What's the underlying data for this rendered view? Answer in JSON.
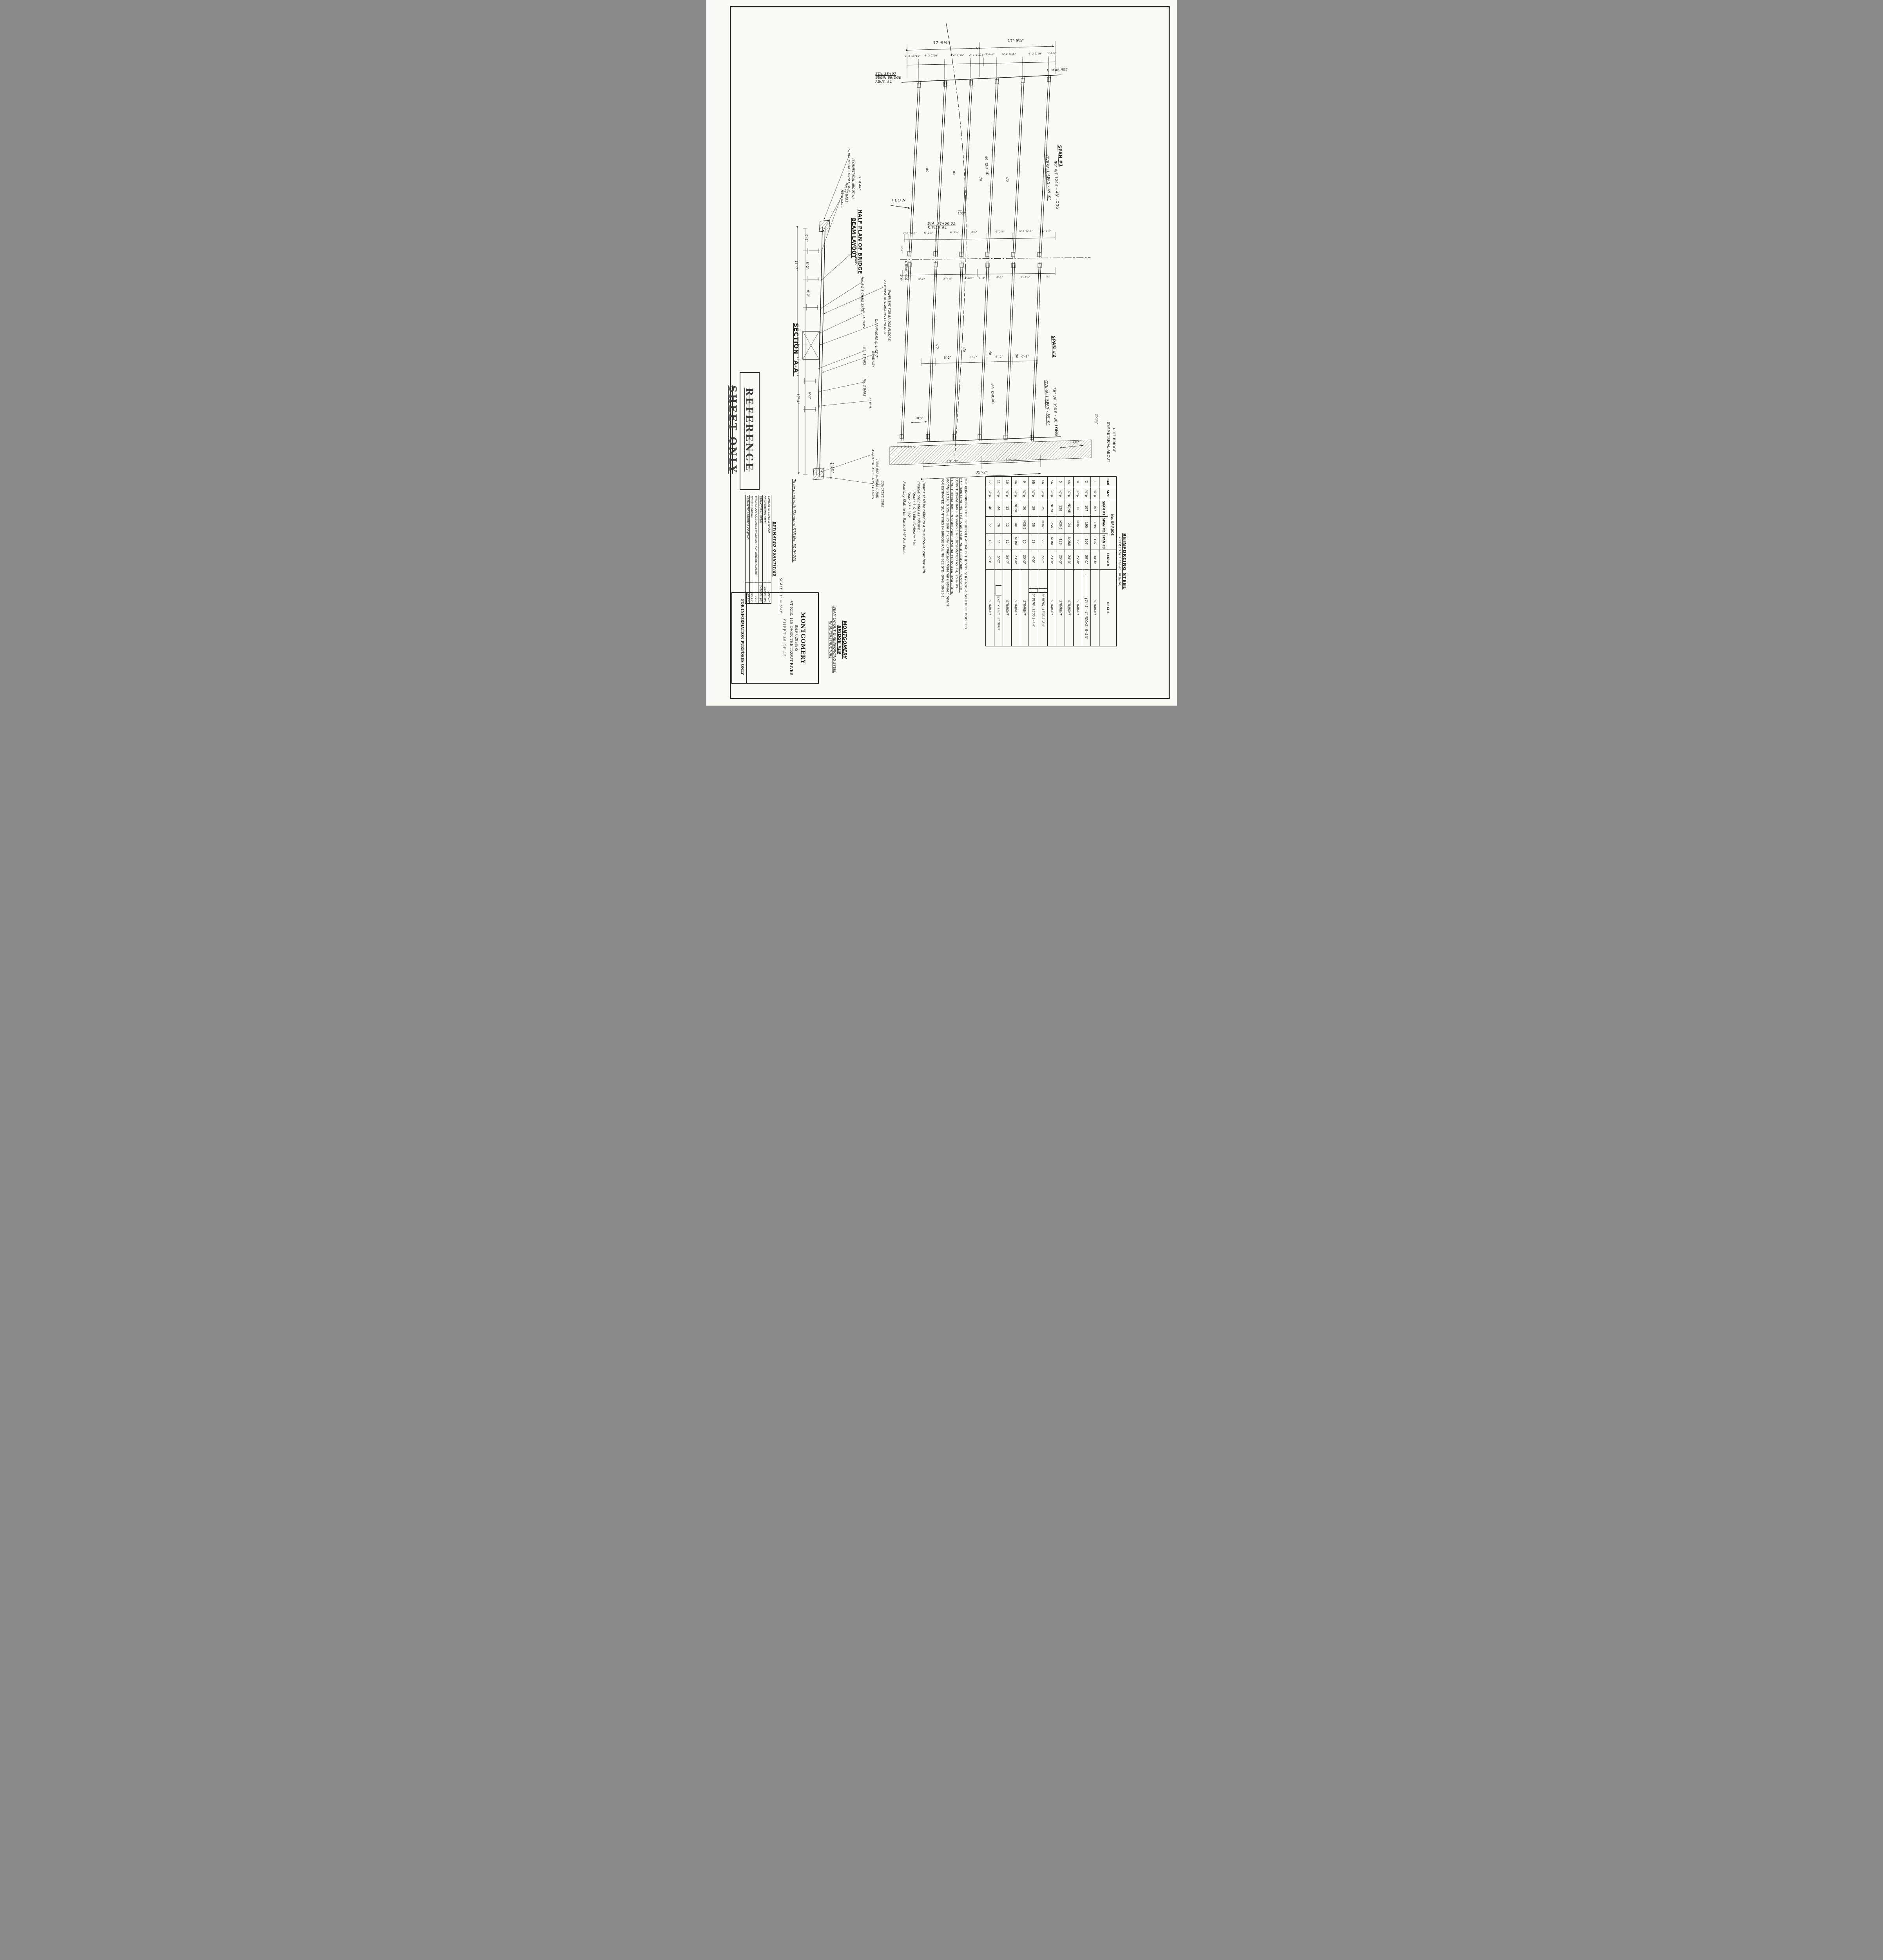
{
  "sheet": {
    "stamp": "REFERENCE SHEET ONLY",
    "scale_note": "SCALE : 1\" = 5'-0\"",
    "usage_note": "To be used with Standard S1B No. 30 (H-20).",
    "info_note": "FOR INFORMATION PURPOSES ONLY"
  },
  "title_block": {
    "town": "MONTGOMERY",
    "project": "BHF 0283(8)S",
    "route": "VT RTE. 118 OVER THE TROUT RIVER",
    "sheet_no": "SHEET 45 OF 45",
    "hand_title": [
      "MONTGOMERY",
      "BRIDGE #19",
      "BEAM LAYOUT & REINFORCING STEEL",
      "IN SUPERSTRUCTURE"
    ]
  },
  "quantities": {
    "title": "ESTIMATED QUANTITIES",
    "rows": [
      {
        "item": "CONCRETE CLASS B (MOD)",
        "qty": "198 C.Y."
      },
      {
        "item": "REINFORCING STEEL",
        "qty": "44240 LBS."
      },
      {
        "item": "STRUCTURAL STEEL",
        "qty": "247090 LBS."
      },
      {
        "item": "BITUMINOUS CONCRETE PAVEMENT FOR BRIDGE FLOORS",
        "qty": "70 T."
      },
      {
        "item": "BRIDGE RAILING",
        "qty": "379 L.F."
      },
      {
        "item": "ASPHALTIC ASBESTOS COATING",
        "qty": "67 S.Y."
      }
    ]
  },
  "rebar": {
    "title": "REINFORCING STEEL",
    "subtitle": "REFER TO STD. S1B No. 30 (H-20)",
    "h_bar": "BAR",
    "h_size": "SIZE",
    "h_rods": "No. OF RODS",
    "h_span1": "SPAN #1",
    "h_span2": "SPAN #2",
    "h_span3": "SPAN #3",
    "h_length": "LENGTH",
    "h_detail": "DETAIL",
    "straight": "STRAIGHT",
    "rows": [
      {
        "bar": "1",
        "size": "⅝\"φ",
        "s1": "107",
        "s2": "195",
        "s3": "107",
        "len": "34'-6\"",
        "detail": "STRAIGHT"
      },
      {
        "bar": "2",
        "size": "⅝\"φ",
        "s1": "107",
        "s2": "195",
        "s3": "107",
        "len": "36'-1\"",
        "detail": "34'-1\" · 4\" HOOKS · R=2½\""
      },
      {
        "bar": "4",
        "size": "¾\"φ",
        "s1": "12",
        "s2": "NONE",
        "s3": "12",
        "len": "25'-8\"",
        "detail": "STRAIGHT"
      },
      {
        "bar": "4A",
        "size": "¾\"φ",
        "s1": "NONE",
        "s2": "24",
        "s3": "NONE",
        "len": "24'-3\"",
        "detail": "STRAIGHT"
      },
      {
        "bar": "5",
        "size": "½\"φ",
        "s1": "128",
        "s2": "NONE",
        "s3": "128",
        "len": "25'-3\"",
        "detail": "STRAIGHT"
      },
      {
        "bar": "5A",
        "size": "½\"φ",
        "s1": "NONE",
        "s2": "256",
        "s3": "NONE",
        "len": "23'-8\"",
        "detail": "STRAIGHT"
      },
      {
        "bar": "6A",
        "size": "½\"φ",
        "s1": "29",
        "s2": "NONE",
        "s3": "29",
        "len": "5'-7\"",
        "detail": "8\" BEND · LEGS 2'-2½\""
      },
      {
        "bar": "6B",
        "size": "½\"φ",
        "s1": "29",
        "s2": "58",
        "s3": "29",
        "len": "4'-5\"",
        "detail": "8\" BEND · LEGS 1'-7¼\""
      },
      {
        "bar": "9",
        "size": "½\"φ",
        "s1": "20",
        "s2": "NONE",
        "s3": "20",
        "len": "25'-3\"",
        "detail": "STRAIGHT"
      },
      {
        "bar": "9A",
        "size": "½\"φ",
        "s1": "NONE",
        "s2": "40",
        "s3": "NONE",
        "len": "23'-8\"",
        "detail": "STRAIGHT"
      },
      {
        "bar": "10",
        "size": "⅜\"φ",
        "s1": "12",
        "s2": "12",
        "s3": "12",
        "len": "34'-7\"",
        "detail": "STRAIGHT"
      },
      {
        "bar": "11",
        "size": "½\"φ",
        "s1": "44",
        "s2": "76",
        "s3": "44",
        "len": "5'-2\"",
        "detail": "2'-2\" × 1'-3\" · 3\" HOOK"
      },
      {
        "bar": "12",
        "size": "½\"φ",
        "s1": "40",
        "s2": "72",
        "s3": "40",
        "len": "2'-3\"",
        "detail": "STRAIGHT"
      }
    ]
  },
  "notes": {
    "n1": "THE REINFORCING STEEL SCHEDULE ABOVE IS THE STD. S1B (H-20)-1 SCHEDULE MODIFIED",
    "n2": "BY ELIMINATING No. 3 BARS AND SPACING #1 & #2 BARS @ 5½\" C/C.",
    "n3": "LONGITUDINAL BARS IN SPANS 1 & 3 DESIGNATED AS #4, #5 & #9.",
    "n4": "LONGITUDINAL BARS IN SPAN 2 ARE DESIGNATED AS #4A, #5A & #9A.",
    "n5": "Modify S1B30 (H20)-1 to use 1\" Cork Expansion Material Between Spans.",
    "n6": "FOR ESTIMATED QUANTITIES IN BRIDGE RAILING SEE STD. DWG. 38-55-1",
    "c1": "Beams shall be rolled to a true circular camber with",
    "c2": "middle ordinates as follows :",
    "c3": "Spans 1 & 3   Mid. Ordinate  1⅛\"",
    "c4": "Span  2            \"            \"            3¾\"",
    "c5": "Roadway Slab to be Banked ½\" Per Foot."
  },
  "plan": {
    "half_plan_1": "HALF PLAN OF BRIDGE",
    "half_plan_2": "BEAM LAYOUT",
    "flow": "FLOW",
    "ditto": "do",
    "angle": "102°",
    "sta_begin_1": "STA. 38+07",
    "sta_begin_2": "BEGIN BRIDGE",
    "sta_begin_3": "ABUT. #1",
    "sta_pier_1": "STA. 38+56.01",
    "sta_pier_2": "℄ PIER #1",
    "bearings": "℄ BEARINGS",
    "sym_1": "SYMMETRICAL ABOUT",
    "sym_2": "℄ OF BRIDGE",
    "span1": {
      "title": "SPAN #1",
      "overall": "OVERALL SPAN - 49'-0\"",
      "beam": "30\" WF 124# - 48' LONG",
      "chord": "49' CHORD"
    },
    "span2": {
      "title": "SPAN #2",
      "overall": "OVERALL SPAN - 89'-0\"",
      "beam": "36\" WF 300# - 88' LONG",
      "chord": "89' CHORD"
    },
    "dims": {
      "top": [
        "17'-9⅜\"",
        "17'-9⅝\""
      ],
      "sub": [
        "2'-8 13/16\"",
        "6'-2 7/16\"",
        "6'-2 7/16\"",
        "2'-7 11/16\"",
        "3'-6⅛\"",
        "6'-2 7/16\"",
        "6'-2 7/16\"",
        "1'-9⅜\""
      ],
      "pier_above": [
        "2'-6 7/16\"",
        "6'-2⅞\"",
        "6'-2⅞\"",
        "2⅞\"",
        "6'-2⅞\"",
        "6'-2 7/16\"",
        "1'-7⅞\""
      ],
      "pier_below": [
        "3'-1⅝\"",
        "6'-2\"",
        "2'-4⅛\"",
        "4'-0½\"",
        "6'-2\"",
        "6'-2\"",
        "1'-3⅝\"",
        "⅞\""
      ],
      "span2_mid": [
        "6'-2\"",
        "6'-2\"",
        "6'-2\"",
        "6'-2\""
      ],
      "bottom_left_a": "10½\"",
      "bottom_left_b": "1'-6 7/16\"",
      "bottom_17a": "17'-7\"",
      "bottom_17b": "17'-7\"",
      "bottom_total": "35'-2\"",
      "bottom_right_a": "2'-1⅛\"",
      "bottom_right_b": "6'-9¾\"",
      "pier_small_a": "1'-0\"",
      "pier_small_b": "1'-0\""
    }
  },
  "section": {
    "title": "SECTION \"A-A\"",
    "labels": {
      "struct1": "STRUCTURAL CONNECTION",
      "struct2": "(SYMMETRICAL ABOUT ℄)",
      "item407": "ITEM 407",
      "bars12": "No. 12 BARS",
      "bars9": "No. 9 BARS",
      "bars11": "No. 11 BARS",
      "chairs": "No. 4 & 5 CHAIR BARS",
      "bars5a": "No. 5A BARS",
      "bars1": "No. 1 BARS",
      "bars2": "No. 2 BARS",
      "roadway": "ROADWAY",
      "diaph": "DIAPHRAGMS @ ℄ 42'-7\"",
      "min3": "3\" MIN.",
      "pave1": "2-COURSE BITUMINOUS CONCRETE",
      "pave2": "PAVEMENT FOR BRIDGE FLOORS",
      "coat1": "ASPHALTIC ASBESTOS COATING",
      "coat2": "ITEM 407 (UNDER CURB)",
      "curb": "CONCRETE CURB"
    },
    "dims": {
      "d1": "17'-7\"",
      "d2": "17'-4\"",
      "d62": "6'-2\"",
      "d29": "2'-9¾\""
    }
  }
}
